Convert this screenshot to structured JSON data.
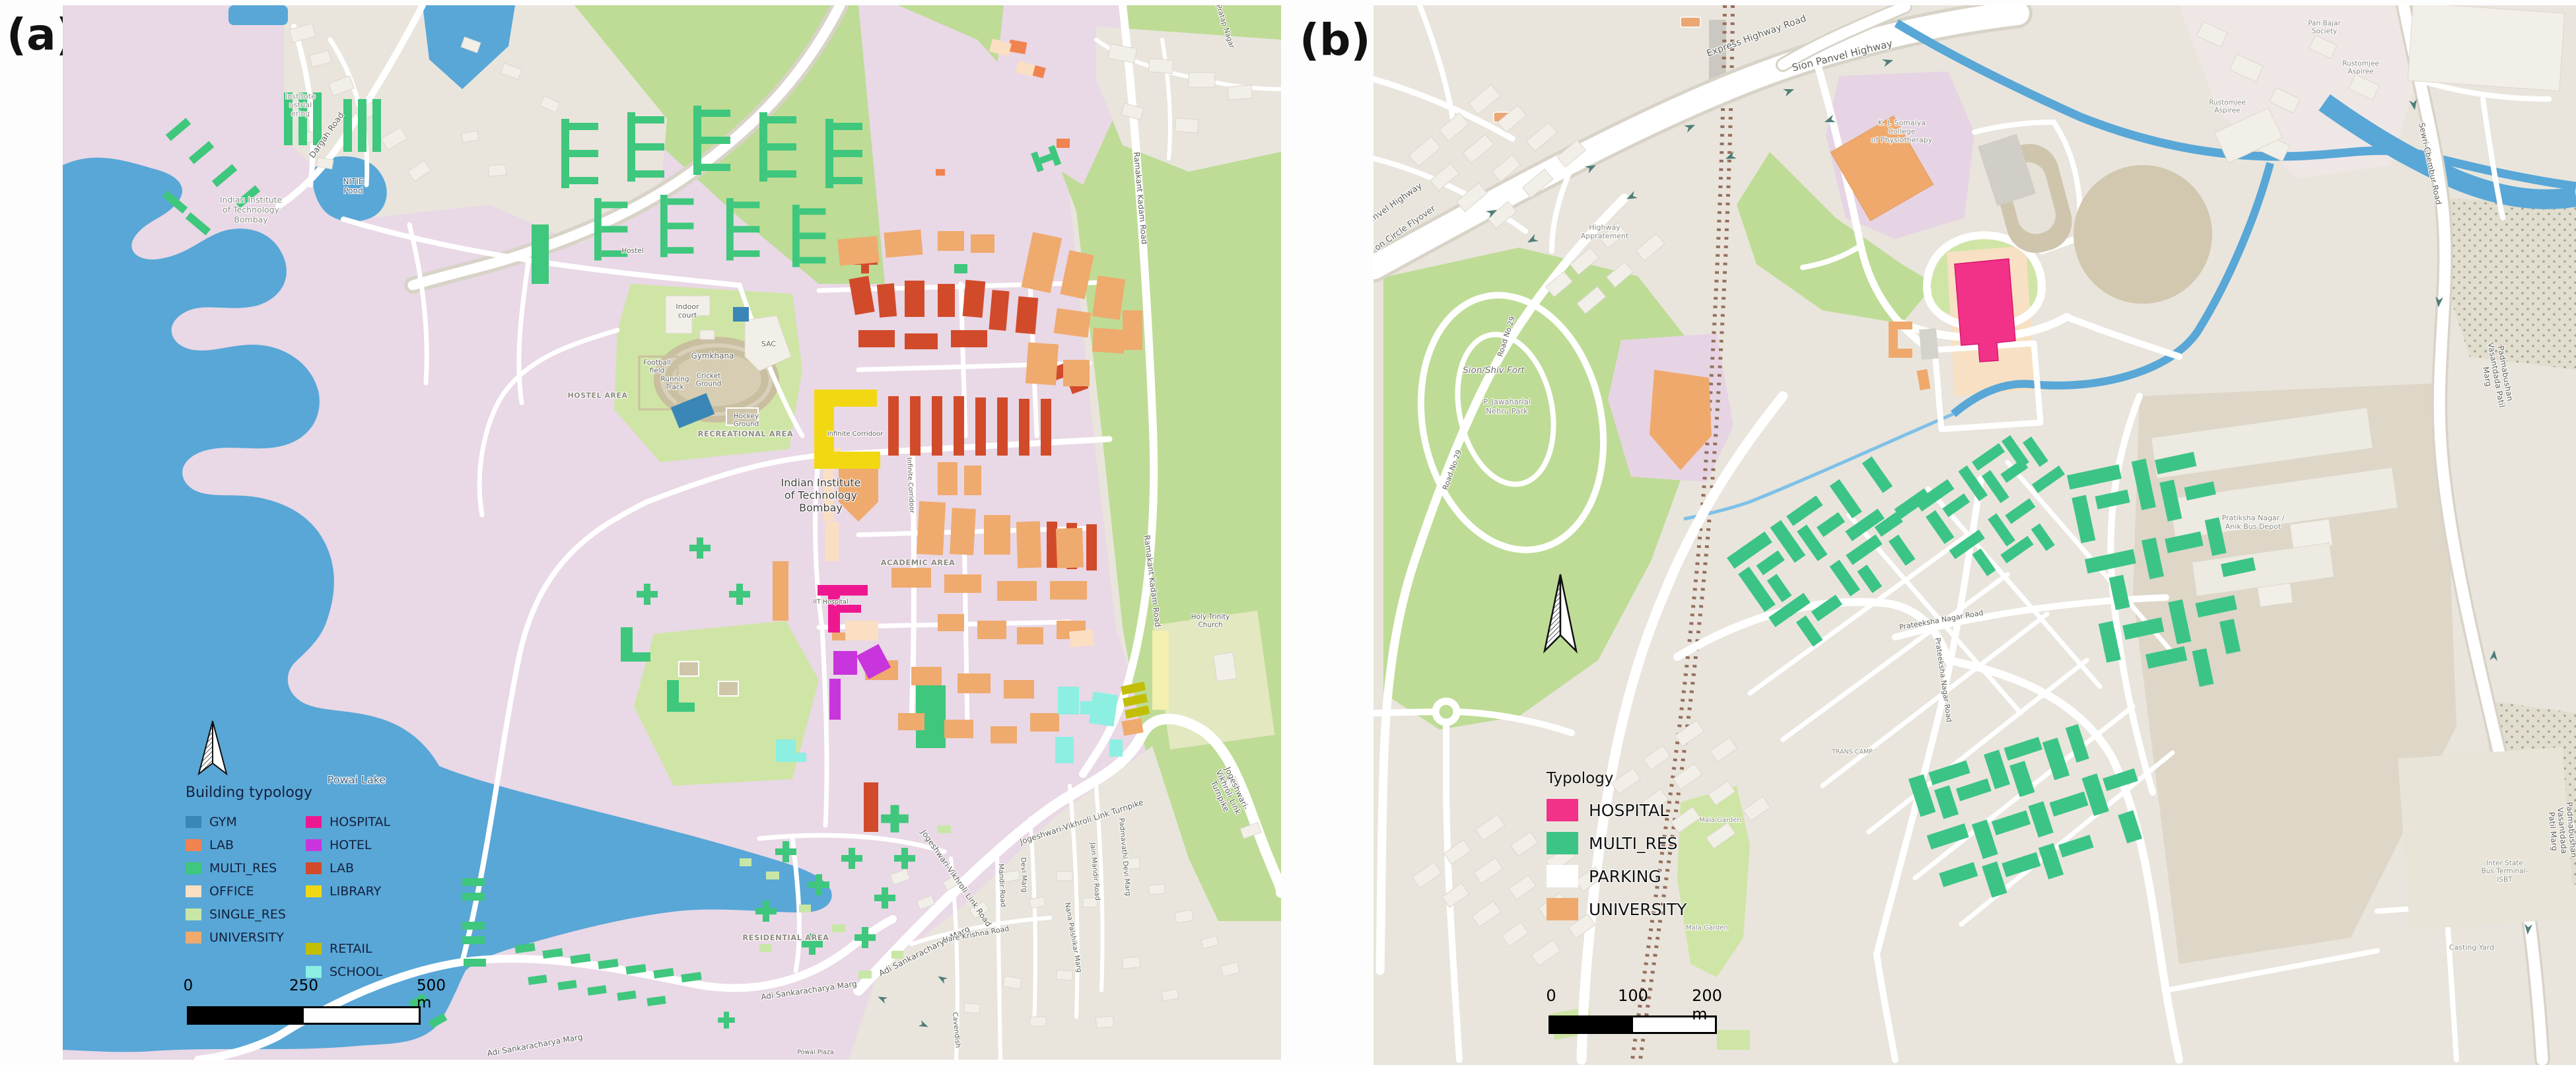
{
  "figure": {
    "panel_a_tag": "(a)",
    "panel_b_tag": "(b)"
  },
  "palette": {
    "gym": "#3a86b7",
    "lab": "#f08350",
    "multires": "#3fc77d",
    "office": "#fadfc3",
    "singleres": "#c8e7a7",
    "university": "#efaa6e",
    "hospital": "#ee1790",
    "hotel": "#c935dc",
    "lab2": "#d14b2b",
    "library": "#f2d813",
    "retail": "#c2be06",
    "school": "#8cefe2",
    "hospital_b": "#f23189",
    "multires_b": "#3cc487",
    "parking_b": "#ffffff",
    "university_b": "#f0a96d",
    "water": "#58a7d7",
    "park_green": "#bedc95",
    "field_green": "#cfe5a5",
    "campus_pink": "#e9d8e6",
    "lavender": "#e6d4e4",
    "urban_beige": "#e9e5dc",
    "depot_beige": "#ded6c7",
    "sand": "#d2c8af",
    "building_white": "#f2efe8",
    "road_casing": "#d8d3c7",
    "rail_brown": "#95705d",
    "arrow_teal": "#4e7d78"
  },
  "map_a": {
    "legend": {
      "title": "Building typology",
      "items": [
        {
          "label": "GYM"
        },
        {
          "label": "LAB"
        },
        {
          "label": "MULTI_RES"
        },
        {
          "label": "OFFICE"
        },
        {
          "label": "SINGLE_RES"
        },
        {
          "label": "UNIVERSITY"
        },
        {
          "label": "HOSPITAL"
        },
        {
          "label": "HOTEL"
        },
        {
          "label": "LAB"
        },
        {
          "label": "LIBRARY"
        },
        {
          "label": "RETAIL"
        },
        {
          "label": "SCHOOL"
        }
      ]
    },
    "scalebar": {
      "t0": "0",
      "t1": "250",
      "t2": "500 m"
    },
    "labels": {
      "powai_lake": "Powai Lake",
      "nitie_inst": "Institute\nustrial\nering",
      "nitie_pond": "NITIE\nPond",
      "dargah_road": "Dargah Road",
      "iit_nw": "Indian Institute\nof Technology\nBombay",
      "hostel": "Hostel",
      "hostel_area": "HOSTEL AREA",
      "indoor_court": "Indoor\ncourt",
      "sac": "SAC",
      "gymkhana": "Gymkhana",
      "football_field": "Football\nfield",
      "running_track": "Running\nTrack",
      "cricket_ground": "Cricket\nGround",
      "hockey_ground": "Hockey\nGround",
      "recreational_area": "RECREATIONAL AREA",
      "infinite_corridoor_h": "Infinite Corridoor",
      "infinite_corridoor_v": "Infinite Corridoor",
      "iit_center": "Indian Institute\nof Technology\nBombay",
      "academic_area": "ACADEMIC AREA",
      "iit_hospital": "IIT Hospital",
      "residential_area": "RESIDENTIAL AREA",
      "adi_marg_1": "Adi Sankaracharya Marg",
      "adi_marg_2": "Adi Sankaracharya Marg",
      "adi_marg_3": "Adi Sankaracharya Marg",
      "jv_link_road": "Jogeshwari-Vikhroli Link Road",
      "jv_turnpike_1": "Jogeshwari-Vikhroli Link Turnpike",
      "jv_turnpike_2": "Jogeshwari-Vikhroli Link Turnpike",
      "ramakant_1": "Ramakant Kadam Road",
      "ramakant_2": "Ramakant Kadam Road",
      "pratap_nagar": "Pratap Nagar",
      "hare_krishna": "Hare Krishna Road",
      "jain_mandir": "Jain Mandir Road",
      "mandir_road": "Mandir Road",
      "devi_marg": "Devi Marg",
      "padmavathi": "Padmavathi Devi Marg",
      "nana_palshikar": "Nana Palshikar Marg",
      "cavendish": "Cavendish",
      "holy_trinity": "Holy Trinity\nChurch",
      "powai_plaza": "Powai Plaza"
    }
  },
  "map_b": {
    "legend": {
      "title": "Typology",
      "items": [
        {
          "label": "HOSPITAL"
        },
        {
          "label": "MULTI_RES"
        },
        {
          "label": "PARKING"
        },
        {
          "label": "UNIVERSITY"
        }
      ]
    },
    "scalebar": {
      "t0": "0",
      "t1": "100",
      "t2": "200 m"
    },
    "labels": {
      "express_hw": "Express Highway Road",
      "sion_panvel": "Sion Panvel Highway",
      "panvel_flyover_1": "Panvel Highway",
      "panvel_flyover_2": "on Circle Flyover",
      "highway_appt": "Highway\nAppratement",
      "kj_somaiya": "K. J. Somaiya\nCollege\nof Physiotherapy",
      "pan_bajar": "Pan Bajar\nSociety",
      "rustomjee_1": "Rustomjee\nAspiree",
      "rustomjee_2": "Rustomjee\nAspiree",
      "sion_fort": "Sion/Shiv Fort",
      "nehru_park": "P. Jawaharlal\nNehru Park",
      "road29_1": "Road No 29",
      "road29_2": "Road No 29",
      "prateeksha_1": "Prateeksha Nagar Road",
      "prateeksha_2": "Prateeksha Nagar Road",
      "mala_garden_1": "Mala Garden",
      "mala_garden_2": "Mala Garden",
      "trans_camp": "TRANS CAMP",
      "pratiksha_depot": "Pratiksha Nagar /\nAnik Bus Depot",
      "isbt": "Inter State\nBus Terminal-\nISBT",
      "casting_yard": "Casting Yard",
      "padma_marg_1": "Padmabushan Vasantdada Patil Marg",
      "padma_marg_2": "Padmabushan Vasantdada Patil Marg",
      "sewri_chembur": "Sewri-Chembur Road"
    }
  }
}
